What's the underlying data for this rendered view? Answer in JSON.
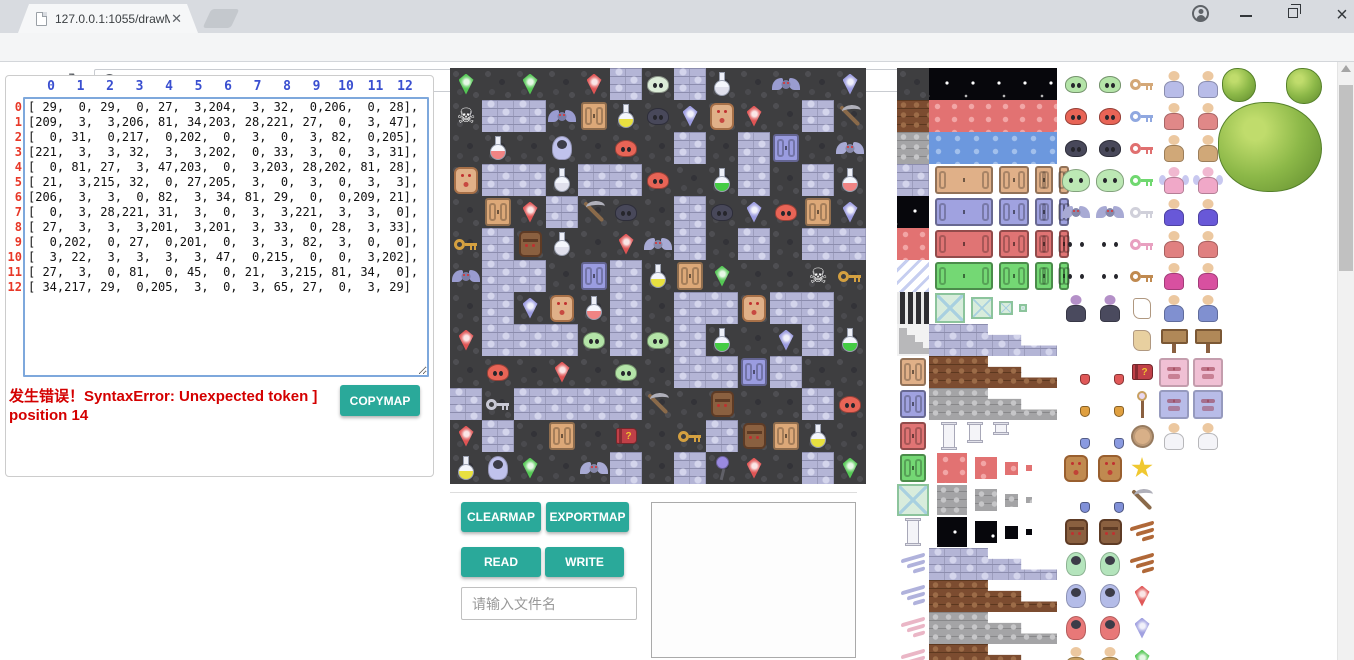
{
  "browser": {
    "tab_title": "127.0.0.1:1055/drawMa",
    "url": "127.0.0.1:1055/drawMapGUI.html"
  },
  "panel_left": {
    "col_headers": [
      "0",
      "1",
      "2",
      "3",
      "4",
      "5",
      "6",
      "7",
      "8",
      "9",
      "10",
      "11",
      "12"
    ],
    "row_headers": [
      "0",
      "1",
      "2",
      "3",
      "4",
      "5",
      "6",
      "7",
      "8",
      "9",
      "10",
      "11",
      "12"
    ],
    "error_text": "发生错误！SyntaxError: Unexpected token ] position 14",
    "copymap_label": "COPYMAP"
  },
  "controls": {
    "clearmap_label": "CLEARMAP",
    "exportmap_label": "EXPORTMAP",
    "read_label": "READ",
    "write_label": "WRITE",
    "filename_placeholder": "请输入文件名"
  },
  "map": {
    "rows": 13,
    "cols": 13,
    "tile_px": 32,
    "matrix": [
      [
        29,
        0,
        29,
        0,
        27,
        3,
        204,
        3,
        32,
        0,
        206,
        0,
        28
      ],
      [
        209,
        3,
        3,
        206,
        81,
        34,
        203,
        28,
        221,
        27,
        0,
        3,
        47
      ],
      [
        0,
        31,
        0,
        217,
        0,
        202,
        0,
        3,
        0,
        3,
        82,
        0,
        205
      ],
      [
        221,
        3,
        3,
        32,
        3,
        3,
        202,
        0,
        33,
        3,
        0,
        3,
        31
      ],
      [
        0,
        81,
        27,
        3,
        47,
        203,
        0,
        3,
        203,
        28,
        202,
        81,
        28
      ],
      [
        21,
        3,
        215,
        32,
        0,
        27,
        205,
        3,
        0,
        3,
        0,
        3,
        3
      ],
      [
        206,
        3,
        3,
        0,
        82,
        3,
        34,
        81,
        29,
        0,
        0,
        209,
        21
      ],
      [
        0,
        3,
        28,
        221,
        31,
        3,
        0,
        3,
        3,
        221,
        3,
        3,
        0
      ],
      [
        27,
        3,
        3,
        3,
        201,
        3,
        201,
        3,
        33,
        0,
        28,
        3,
        33
      ],
      [
        0,
        202,
        0,
        27,
        0,
        201,
        0,
        3,
        3,
        82,
        3,
        0,
        0
      ],
      [
        3,
        22,
        3,
        3,
        3,
        3,
        47,
        0,
        215,
        0,
        0,
        3,
        202
      ],
      [
        27,
        3,
        0,
        81,
        0,
        45,
        0,
        21,
        3,
        215,
        81,
        34,
        0
      ],
      [
        34,
        217,
        29,
        0,
        205,
        3,
        0,
        3,
        65,
        27,
        0,
        3,
        29
      ]
    ],
    "legend": {
      "0": "floor",
      "3": "brickwall",
      "21": "key:#d4a040",
      "22": "key:#c8c8d4",
      "27": "gem:#e05454",
      "28": "gem:#9a9ae0",
      "29": "gem:#54c854",
      "31": "flask:#f08484",
      "32": "flask:#e0e0ec",
      "33": "flask:#44cc44",
      "34": "flask:#e8e040",
      "45": "book:#c04048",
      "47": "pick:#8a6a4a",
      "65": "mace:#9a8ae0",
      "81": "door:#dca878",
      "82": "door:#9a9ce0",
      "201": "blob:#b4e4a8",
      "202": "blob:#e86456",
      "203": "blob:#48485a",
      "204": "blob:#dcecd8",
      "205": "bat:#a8aad4",
      "206": "bat:#9a9cd0",
      "209": "skull:#f8f8f8",
      "215": "moai:#8a6040",
      "217": "ghost:#c0c2ec",
      "221": "golem:#e0b088"
    }
  },
  "tileset": {
    "tile_px": 32,
    "terrain_col": [
      "t:floor",
      "t:brown",
      "t:gray",
      "t:brick",
      "t:starry",
      "t:red",
      "t:stripes",
      "t:bars",
      "t:stairs",
      "door:#e0b088",
      "door:#a0a2e0",
      "door:#e07474",
      "door:#74d874",
      "t:crystal",
      "pillar:#f4f4f8",
      "wingitem:#b0b2dc",
      "wingitem:#b0b2dc",
      "wingitem:#eab6c6",
      "wingitem:#eab6c6"
    ],
    "big_col": [
      "b:starry",
      "b:red",
      "b:water",
      "doors:#e0b088",
      "doors:#a0a2e0",
      "doors:#e07474",
      "doors:#74d874",
      "crystals",
      "steps:brick",
      "steps:brown",
      "steps:gray",
      "pillars",
      "shrink:red",
      "shrink:gray",
      "shrink:starry",
      "steps:brick",
      "steps:brown",
      "steps:gray",
      "steps:brown"
    ],
    "creatures": [
      "blob:#b4e4a8",
      "blob:#e86456",
      "blob:#48485a",
      "bigblob:#bce8b4",
      "bat:#a8aad4",
      "bigbat:#9a9cd0",
      "bigbat:#d05858",
      "vampire:#4a4a5e",
      "skull:#ffffff",
      "skullwar:#e05858",
      "skullwar:#e0a040",
      "skullwar:#8a9ae0",
      "golem:#c08a50",
      "skullwar:#8090d8",
      "moai:#8a6040",
      "ghost:#b4e4bc",
      "ghost:#b4bce8",
      "ghost:#e87878",
      "person:#c8a060"
    ],
    "items": [
      "key:#d4a878",
      "key:#90a8e0",
      "key:#e07070",
      "key:#70d870",
      "key:#d0d0da",
      "key:#e8a0c0",
      "key:#c08a50",
      "scroll:#ffffff",
      "scroll:#e8d0a0",
      "book:#c04048",
      "staff:#a87848",
      "coin:#d8b088",
      "star:#f0c830",
      "pick:#8a6a4a",
      "wingitem:#b06838",
      "wingitem:#b06838",
      "gem:#e05858",
      "gem:#a0a0e0",
      "gem:#58c858"
    ],
    "chars": [
      "person:#b8bce8",
      "person:#e08888",
      "person:#d0a878",
      "fairy:#f0a8c8",
      "person:#6858d8",
      "person:#e08080",
      "person:#d850a0",
      "person:#8090d0",
      "sign:#b08858",
      "wallface:#f0c0d4",
      "wallface:#b8bce8",
      "person:#f4f4f8"
    ],
    "trees": [
      {
        "x": 325,
        "y": 0,
        "w": 34,
        "h": 34
      },
      {
        "x": 389,
        "y": 0,
        "w": 36,
        "h": 36
      },
      {
        "x": 321,
        "y": 34,
        "w": 104,
        "h": 90
      }
    ]
  },
  "colors": {
    "accent_teal": "#2aa99a",
    "error_red": "#d40000",
    "header_blue": "#3a4fd0",
    "row_red": "#e83828"
  }
}
